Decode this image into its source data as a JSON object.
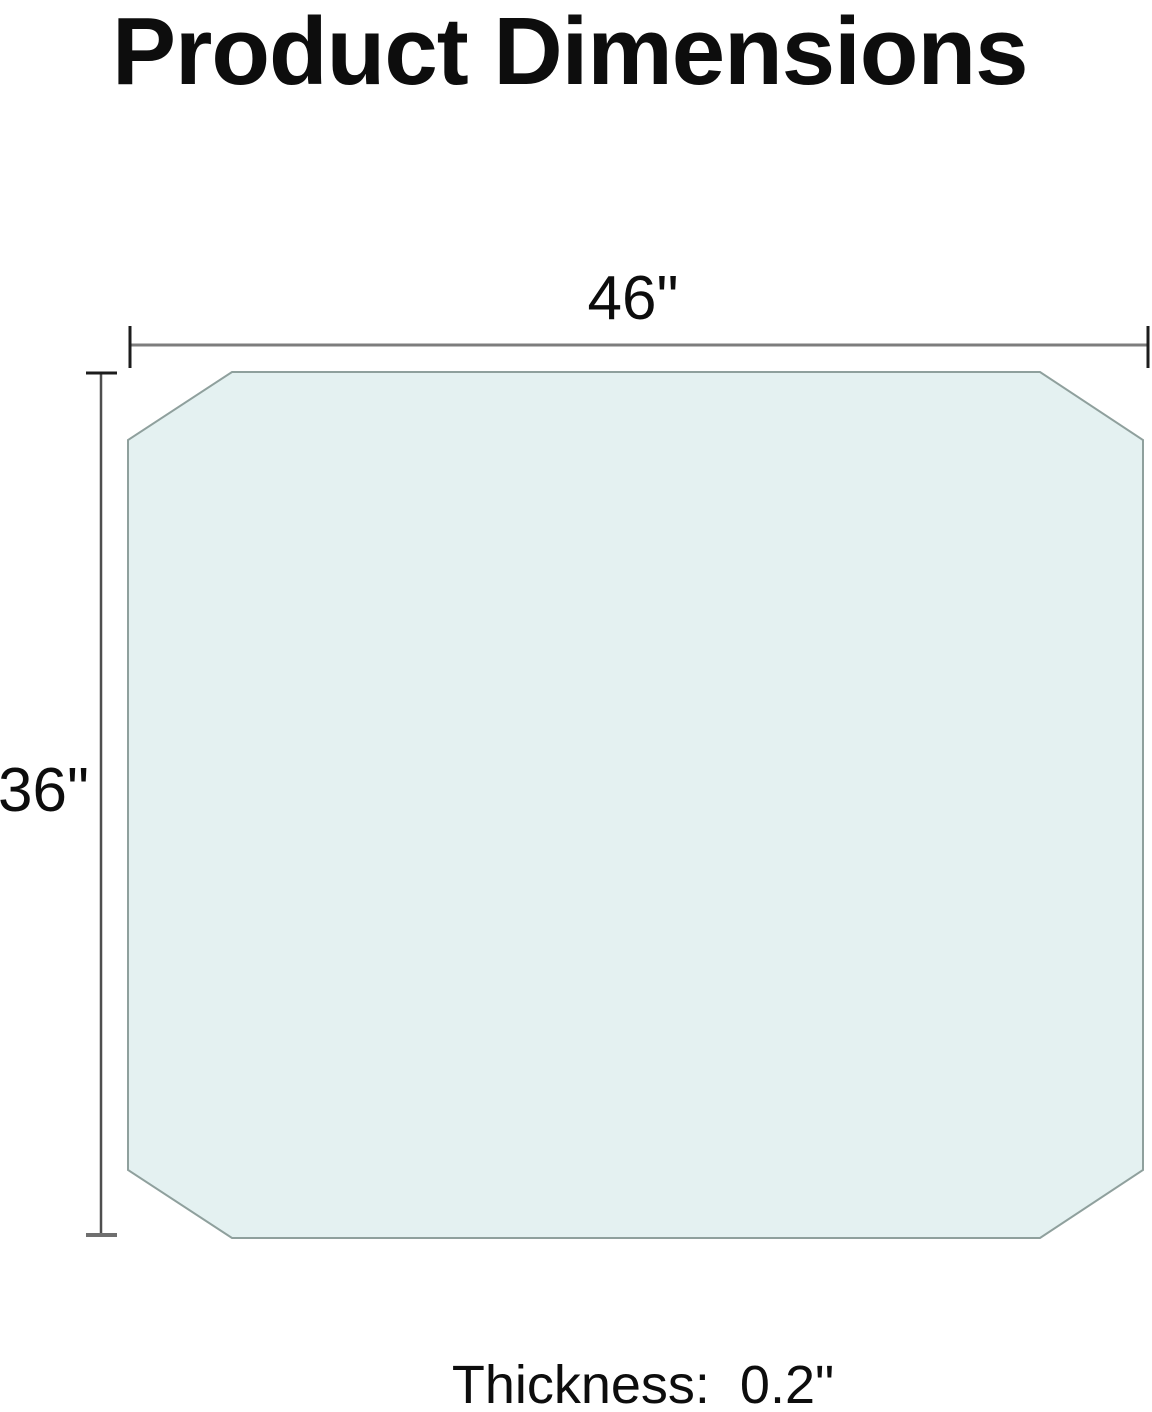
{
  "page": {
    "title": "Product Dimensions"
  },
  "diagram": {
    "width_label": "46\"",
    "height_label": "36\"",
    "thickness_label": "Thickness:  0.2\"",
    "width_inches": 46,
    "height_inches": 36,
    "thickness_inches": 0.2,
    "colors": {
      "background": "#ffffff",
      "panel_fill": "#e4f1f1",
      "panel_stroke": "#8fa09d",
      "dimension_line_horizontal": "#7d7d7d",
      "dimension_line_vertical": "#4f4f4f",
      "dimension_tick_dark": "#1c1c1c",
      "dimension_tick_gray": "#6f6f6f",
      "text": "#0d0d0d"
    }
  }
}
